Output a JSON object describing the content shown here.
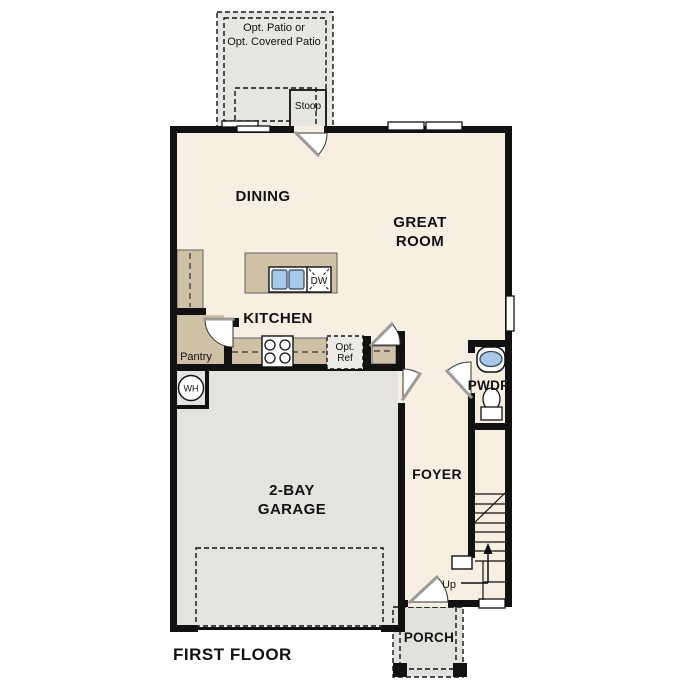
{
  "plan": {
    "title": "FIRST FLOOR",
    "rooms": {
      "dining": "DINING",
      "great_room_line1": "GREAT",
      "great_room_line2": "ROOM",
      "kitchen": "KITCHEN",
      "foyer": "FOYER",
      "pwdr": "PWDR",
      "garage_line1": "2-BAY",
      "garage_line2": "GARAGE",
      "porch": "PORCH",
      "pantry": "Pantry"
    },
    "features": {
      "patio_line1": "Opt. Patio or",
      "patio_line2": "Opt. Covered Patio",
      "stoop": "Stoop",
      "dishwasher": "DW",
      "opt_ref_line1": "Opt.",
      "opt_ref_line2": "Ref",
      "water_heater": "WH",
      "up": "Up"
    }
  },
  "colors": {
    "floor": "#f7efe2",
    "cabinet": "#cfc1a5",
    "garage": "#e4e3e0",
    "patio": "#e7e6e3",
    "porch": "#e2e1de",
    "sink_blue": "#a9c9e9",
    "wall": "#111111"
  }
}
